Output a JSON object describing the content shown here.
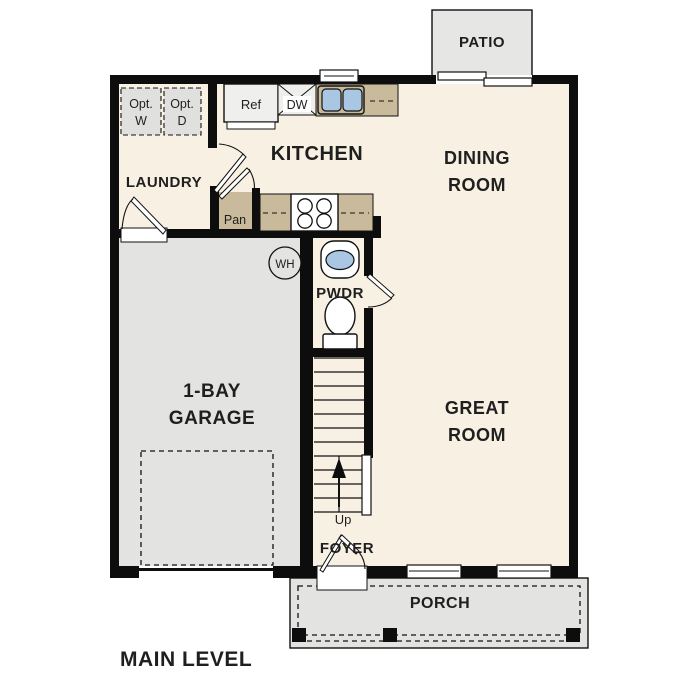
{
  "plan": {
    "level_label": "MAIN LEVEL"
  },
  "colors": {
    "wall": "#0d0d0d",
    "floor": "#f8f1e3",
    "garage_floor": "#e3e3e1",
    "patio_floor": "#e6e6e4",
    "porch_floor": "#e3e3e1",
    "counter": "#c9ba9b",
    "appliance": "#efefed",
    "optional_item": "#e0e0de",
    "water_blue": "#a9c7e3",
    "fixture_white": "#ffffff",
    "text": "#1f1f1f"
  },
  "rooms": {
    "patio": {
      "label": "PATIO"
    },
    "kitchen": {
      "label": "KITCHEN"
    },
    "dining_room": {
      "line1": "DINING",
      "line2": "ROOM"
    },
    "laundry": {
      "label": "LAUNDRY"
    },
    "pantry": {
      "label": "Pan"
    },
    "powder_room": {
      "label": "PWDR"
    },
    "garage": {
      "line1": "1-BAY",
      "line2": "GARAGE"
    },
    "great_room": {
      "line1": "GREAT",
      "line2": "ROOM"
    },
    "foyer": {
      "label": "FOYER"
    },
    "porch": {
      "label": "PORCH"
    }
  },
  "fixtures": {
    "optional_washer": {
      "line1": "Opt.",
      "line2": "W"
    },
    "optional_dryer": {
      "line1": "Opt.",
      "line2": "D"
    },
    "refrigerator": {
      "label": "Ref"
    },
    "dishwasher": {
      "label": "DW"
    },
    "water_heater": {
      "label": "WH"
    },
    "stairs": {
      "label": "Up"
    }
  }
}
